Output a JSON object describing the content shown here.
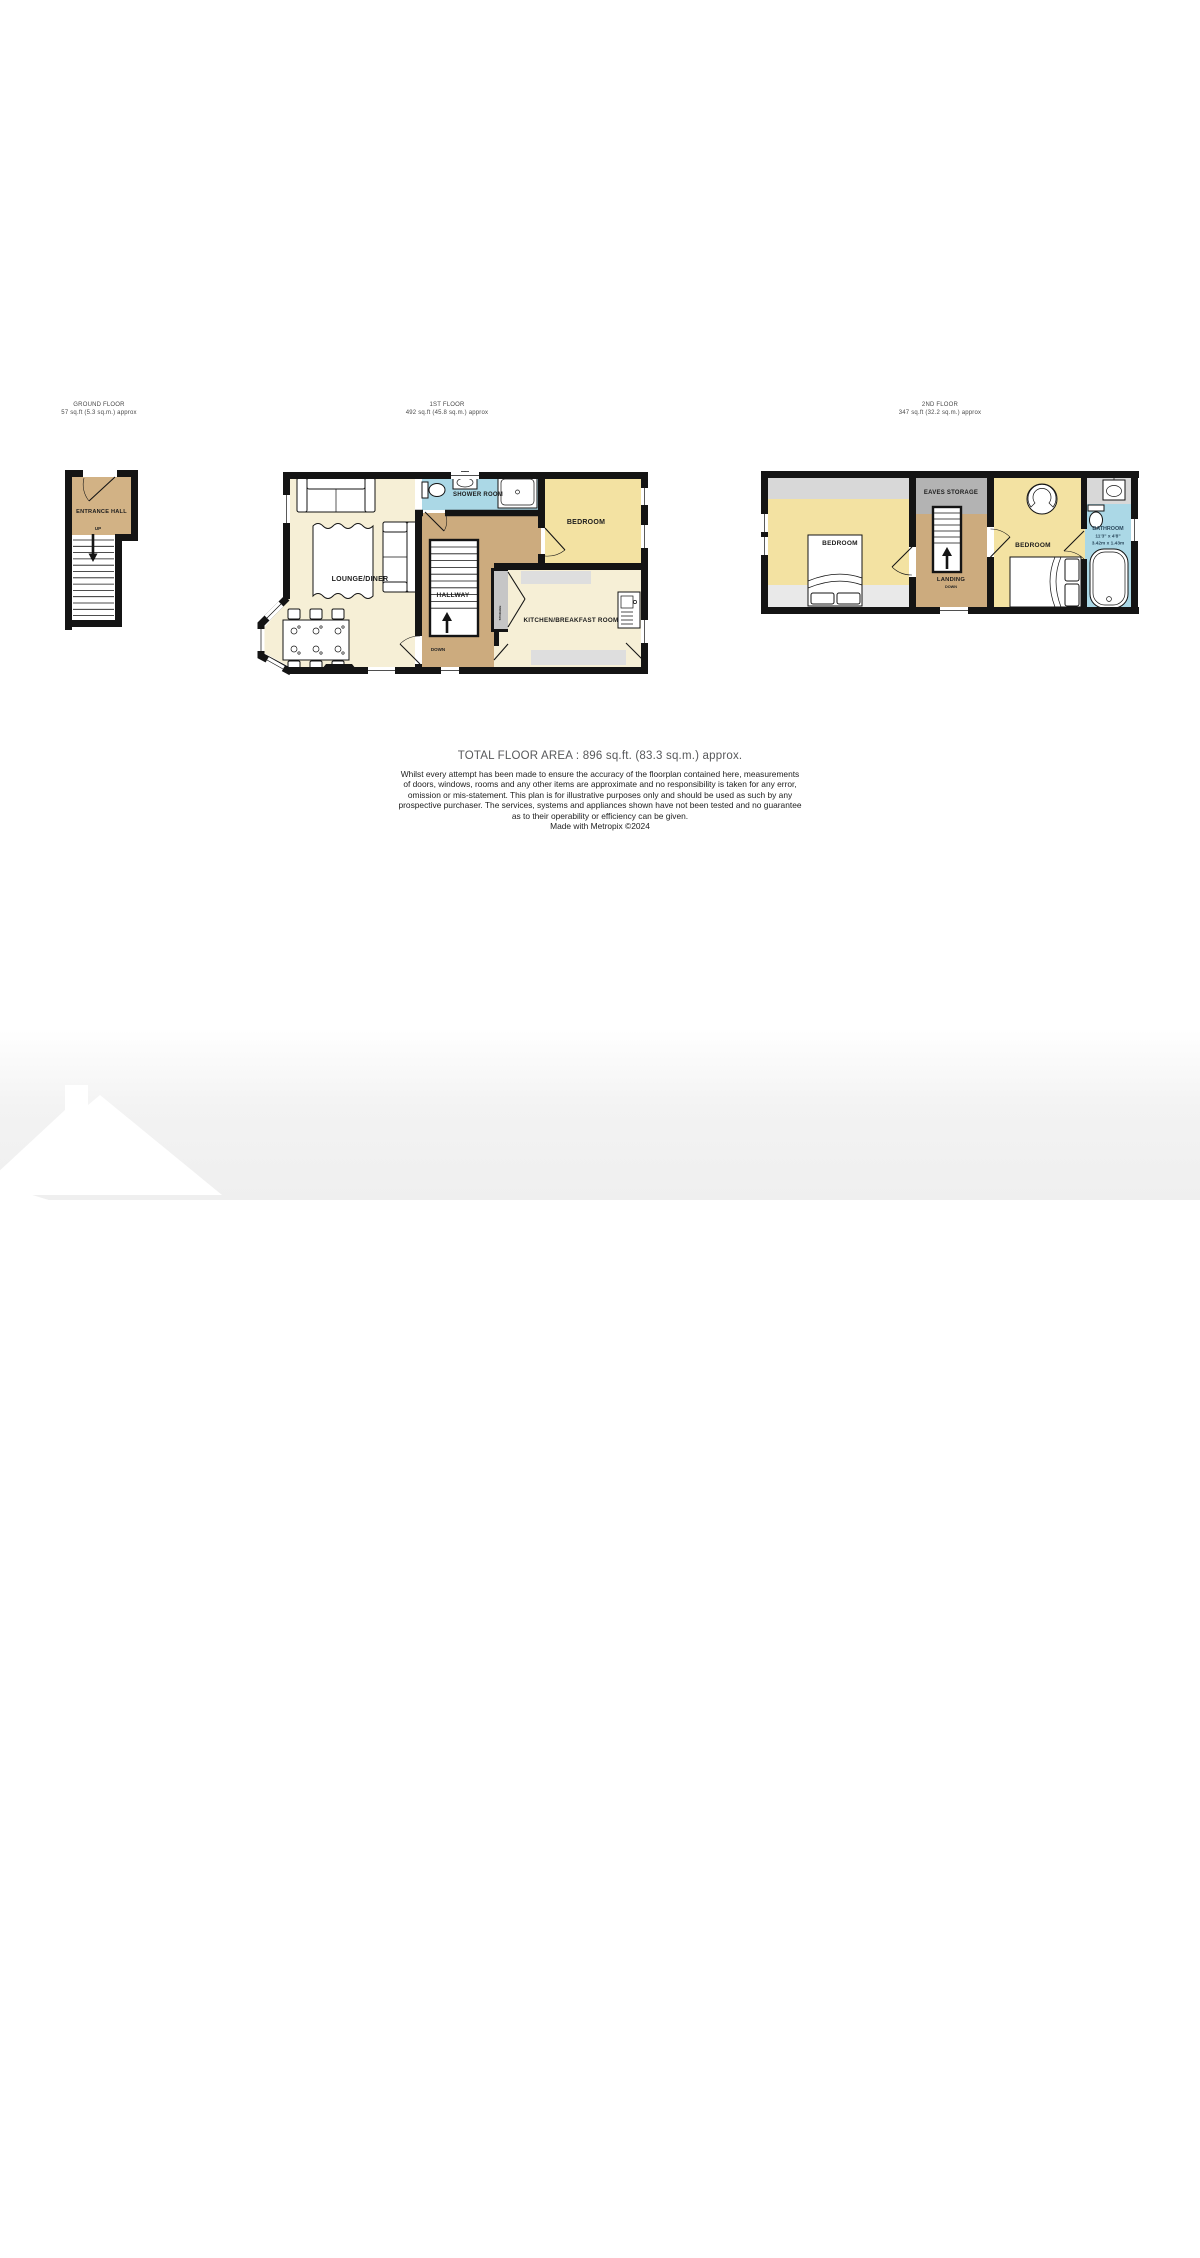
{
  "floors": {
    "ground": {
      "name": "GROUND FLOOR",
      "area": "57 sq.ft (5.3 sq.m.) approx",
      "rooms": {
        "entrance_hall": "ENTRANCE HALL",
        "up": "UP"
      }
    },
    "first": {
      "name": "1ST FLOOR",
      "area": "492 sq.ft (45.8 sq.m.) approx",
      "rooms": {
        "shower_room": "SHOWER ROOM",
        "bedroom": "BEDROOM",
        "lounge_diner": "LOUNGE/DINER",
        "hallway": "HALLWAY",
        "kitchen": "KITCHEN/BREAKFAST ROOM",
        "storage": "STORAGE",
        "down": "DOWN"
      }
    },
    "second": {
      "name": "2ND FLOOR",
      "area": "347 sq.ft (32.2 sq.m.) approx",
      "rooms": {
        "bedroom_left": "BEDROOM",
        "eaves_storage": "EAVES STORAGE",
        "landing": "LANDING",
        "down": "DOWN",
        "bedroom_right": "BEDROOM",
        "bathroom": "BATHROOM"
      },
      "bathroom_dims": {
        "imperial": "11'3\" x 4'8\"",
        "metric": "3.42m x 1.43m"
      }
    }
  },
  "footer": {
    "total_area": "TOTAL FLOOR AREA : 896 sq.ft. (83.3 sq.m.) approx.",
    "disclaimer_lines": [
      "Whilst every attempt has been made to ensure the accuracy of the floorplan contained here, measurements",
      "of doors, windows, rooms and any other items are approximate and no responsibility is taken for any error,",
      "omission or mis-statement. This plan is for illustrative purposes only and should be used as such by any",
      "prospective purchaser. The services, systems and appliances shown have not been tested and no guarantee",
      "as to their operability or efficiency can be given.",
      "Made with Metropix ©2024"
    ]
  },
  "watermark": {
    "brand": "MR. GREEN"
  },
  "colors": {
    "wall": "#141414",
    "cream": "#f6efd6",
    "hall_tan": "#ccab7e",
    "entrance_tan": "#d2b285",
    "bedroom_yellow": "#f3e2a2",
    "bath_blue": "#abd8e6",
    "eaves_gray": "#b3b3b3",
    "band_gray": "#d8d8d8",
    "band_light": "#e9e9e9",
    "counter_gray": "#dedede",
    "storage_gray": "#c6c6c6"
  }
}
